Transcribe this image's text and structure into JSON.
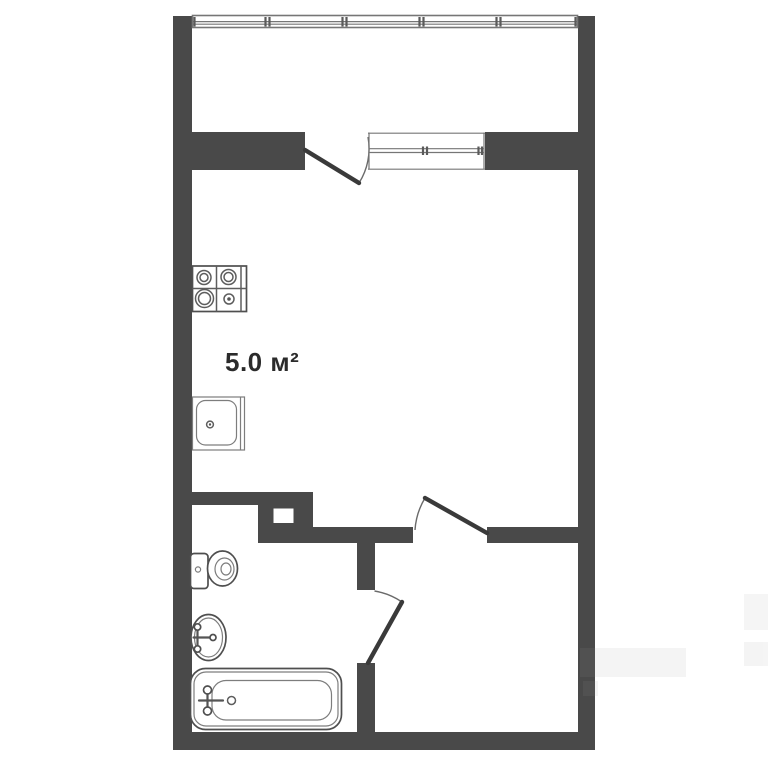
{
  "labels": {
    "kitchen_area": "5.0 м²"
  },
  "fixtures": {
    "stove": "stove-4-burner",
    "kitchen_sink": "kitchen-sink",
    "toilet": "toilet",
    "washbasin": "washbasin",
    "bathtub": "bathtub"
  },
  "openings": {
    "balcony_glazing": "window-band",
    "balcony_door": "door-swing",
    "balcony_window": "window",
    "entry_door": "door-swing",
    "bathroom_door": "door-swing"
  },
  "colors": {
    "wall": "#494949",
    "background": "#ffffff",
    "fixture_stroke": "#4f4f4f",
    "fixture_stroke_light": "#7d7d7d",
    "window_line": "#767676",
    "door": "#3a3a3a",
    "swing_arc": "#6a6a6a",
    "text": "#2b2b2b"
  }
}
